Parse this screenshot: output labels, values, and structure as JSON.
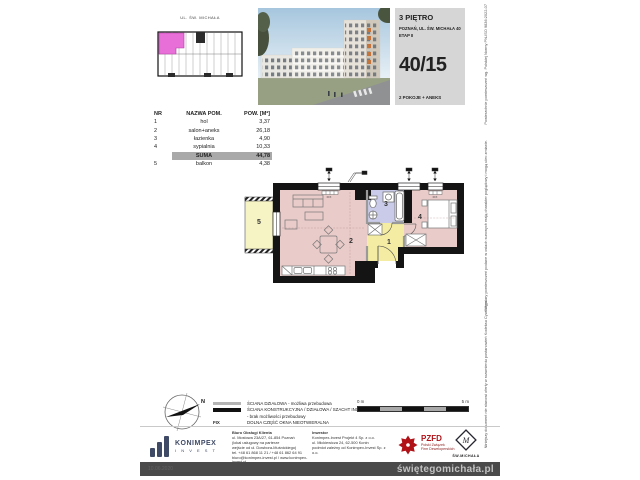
{
  "document": {
    "date": "10.06.2020",
    "website": "świętegomichała.pl"
  },
  "site_plan": {
    "street_label": "UL. ŚW. MICHAŁA"
  },
  "unit_card": {
    "floor": "3 PIĘTRO",
    "address": "POZNAŃ, UL. ŚW. MICHAŁA 40",
    "stage": "ETAP II",
    "unit_number": "40/15",
    "layout": "2 POKOJE + ANEKS"
  },
  "room_table": {
    "headers": [
      "NR",
      "NAZWA POM.",
      "POW. [M²]"
    ],
    "rows": [
      {
        "nr": "1",
        "name": "hol",
        "area": "3,37"
      },
      {
        "nr": "2",
        "name": "salon+aneks",
        "area": "26,18"
      },
      {
        "nr": "3",
        "name": "łazienka",
        "area": "4,90"
      },
      {
        "nr": "4",
        "name": "sypialnia",
        "area": "10,33"
      }
    ],
    "suma_label": "SUMA",
    "suma_area": "44,78",
    "balkon": {
      "nr": "5",
      "name": "balkon",
      "area": "4,38"
    }
  },
  "floor_plan": {
    "numbers": {
      "hol": "1",
      "salon": "2",
      "lazienka": "3",
      "sypialnia": "4",
      "balkon": "5"
    },
    "fix_label": "FIX",
    "compass": "N"
  },
  "legend": {
    "partition_wall": "ŚCIANA DZIAŁOWA - możliwa przebudowa",
    "structural_wall": "ŚCIANA KONSTRUKCYJNA / DZIAŁOWA / SZACHT INSTALACYJNY",
    "structural_wall_2": "- brak możliwości przebudowy",
    "fix_abbr": "FIX",
    "fix_text": "DOLNA CZĘŚĆ OKNA NIEOTWIERALNA",
    "scale_start": "0 m",
    "scale_end": "5 m"
  },
  "notes": {
    "norm": "Powierzchnie pomieszczeń wg. Polskiej Normy PN-ISO 9836:2022-07",
    "dimensions": "Wymiary pomieszczeń podane w osiach surowych mają charakter poglądowy i mogą ulec zmianie.",
    "offer": "Niniejszy dokument nie stanowi oferty w rozumieniu postanowień Kodeksu Cywilnego."
  },
  "footer": {
    "konimpex": {
      "name": "KONIMPEX",
      "sub": "I N V E S T"
    },
    "office": {
      "title": "Biuro Obsługi Klienta",
      "lines": [
        "ul. Mostowa 23A/27, 61-854 Poznań",
        "(lokal usługowy na parterze",
        "wejście od ul. Dowbora-Muśnickiego)",
        "tel. +48 61 868 11 21 / +48 61 862 64 91",
        "biuro@konimpex-invest.pl / www.konimpex-invest.pl"
      ]
    },
    "investor": {
      "title": "Inwestor",
      "lines": [
        "Konimpex-Invest Projekt 4 Sp. z o.o.",
        "ul. Mickiewicza 24, 62-500 Konin",
        "podmiot zależny od Konimpex-Invest Sp. z o.o."
      ]
    },
    "pzfd": {
      "abbr": "PZFD",
      "line1": "Polski Związek",
      "line2": "Firm Deweloperskich"
    },
    "michala": {
      "monogram": "M",
      "label": "ŚW.MICHAŁA"
    }
  },
  "colors": {
    "room_pink": "#e9cbc9",
    "room_blue": "#c9cbe8",
    "room_yellow": "#f3eca2",
    "balcony_yellow": "#f6f3c4",
    "highlight_magenta": "#e76fd7",
    "pzfd_red": "#b01218",
    "footer_bar": "#4a4a4a"
  }
}
